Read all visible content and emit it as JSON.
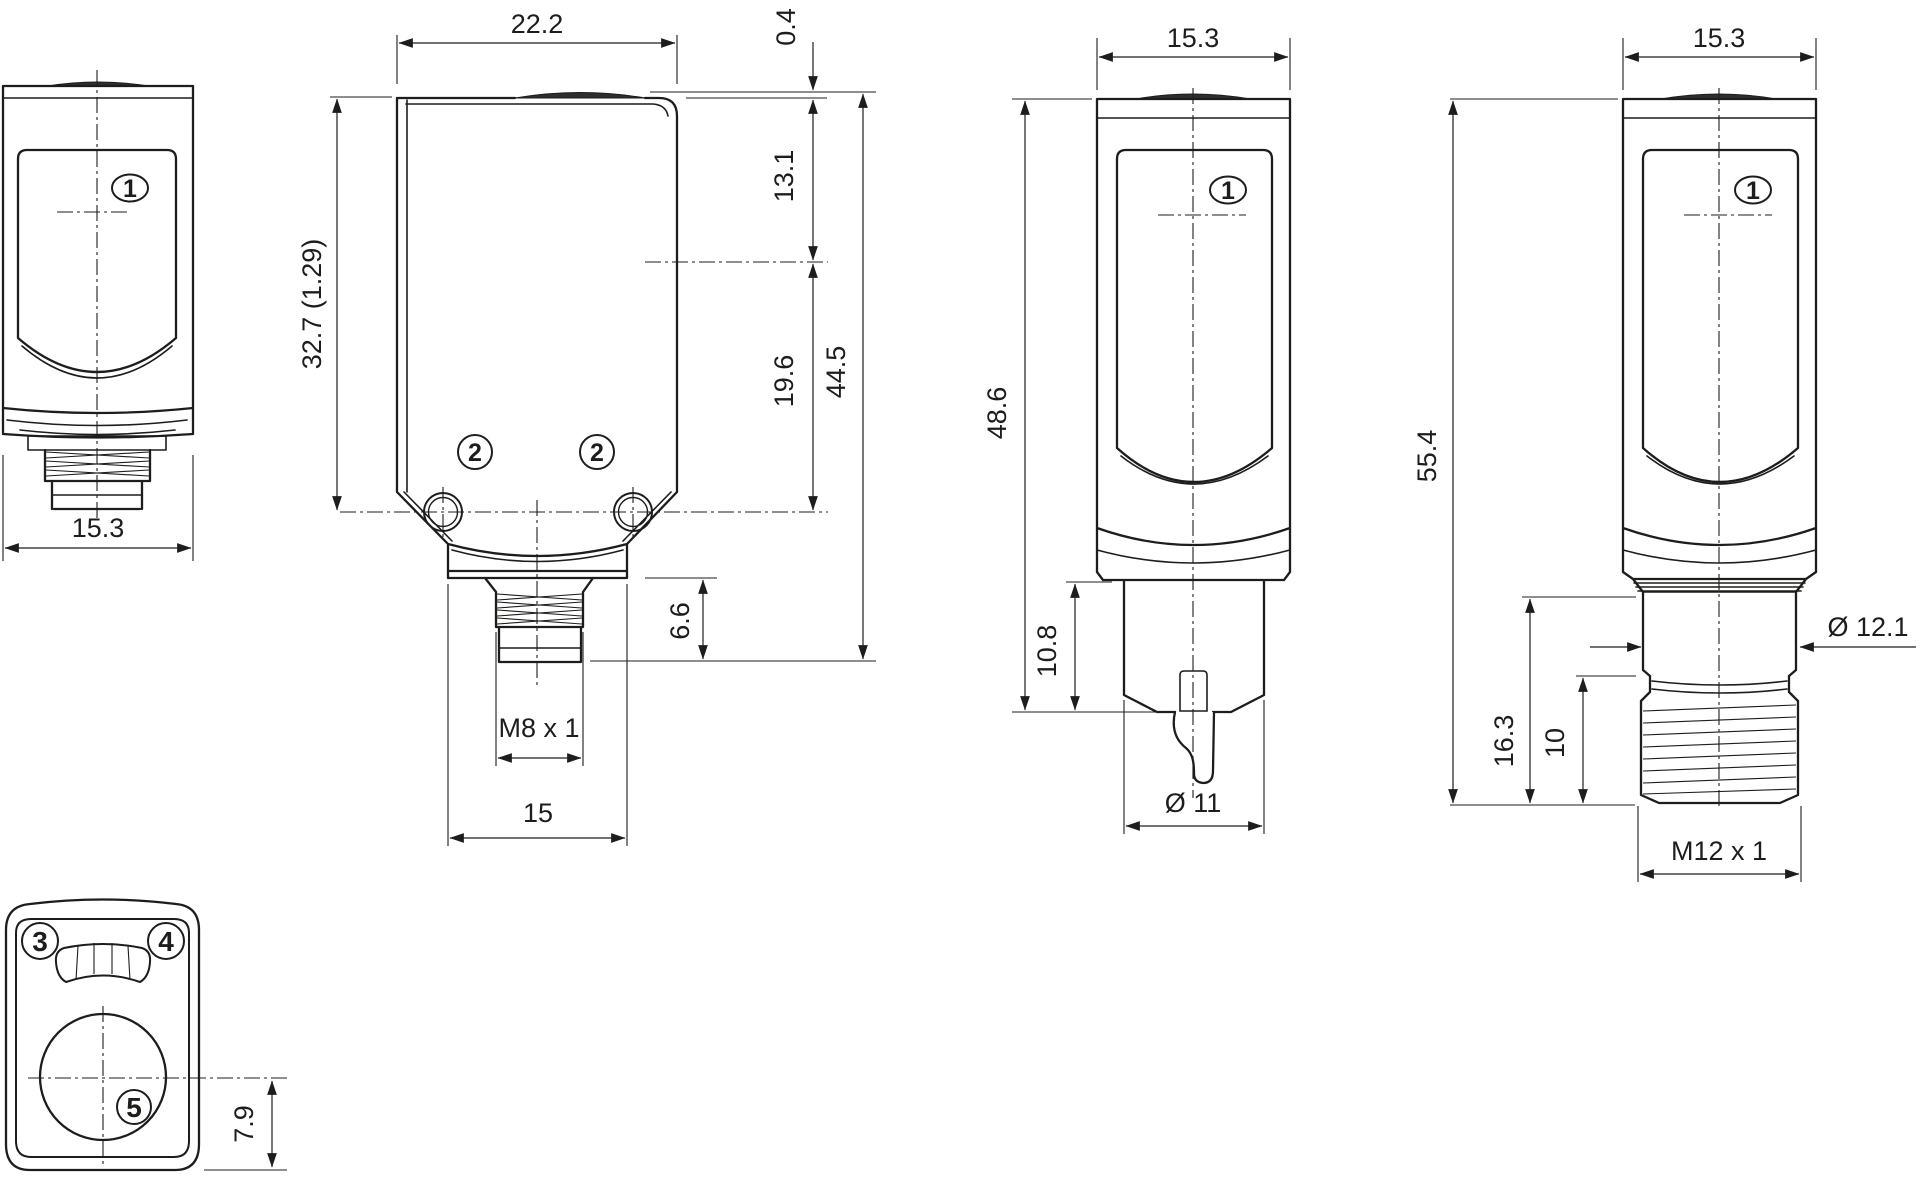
{
  "colors": {
    "line": "#1d1d1b",
    "background": "#ffffff",
    "lens_fill": "#2e2e2e"
  },
  "callouts": {
    "c1": "1",
    "c2": "2",
    "c3": "3",
    "c4": "4",
    "c5": "5"
  },
  "view_side_m8": {
    "width": "15.3"
  },
  "view_front": {
    "width": "22.2",
    "body_height": "32.7 (1.29)",
    "lens_protrusion": "0.4",
    "top_to_axis": "13.1",
    "axis_to_holes": "19.6",
    "overall_height": "44.5",
    "connector_height": "6.6",
    "connector_thread": "M8 x 1",
    "connector_shoulder_width": "15"
  },
  "view_side_cable": {
    "width": "15.3",
    "overall_height": "48.6",
    "gland_height": "10.8",
    "gland_diameter": "Ø 11"
  },
  "view_side_m12": {
    "width": "15.3",
    "overall_height": "55.4",
    "connector_height": "16.3",
    "thread_length": "10",
    "collar_diameter": "Ø 12.1",
    "connector_thread": "M12 x 1"
  },
  "view_bottom": {
    "axis_to_bottom": "7.9"
  }
}
